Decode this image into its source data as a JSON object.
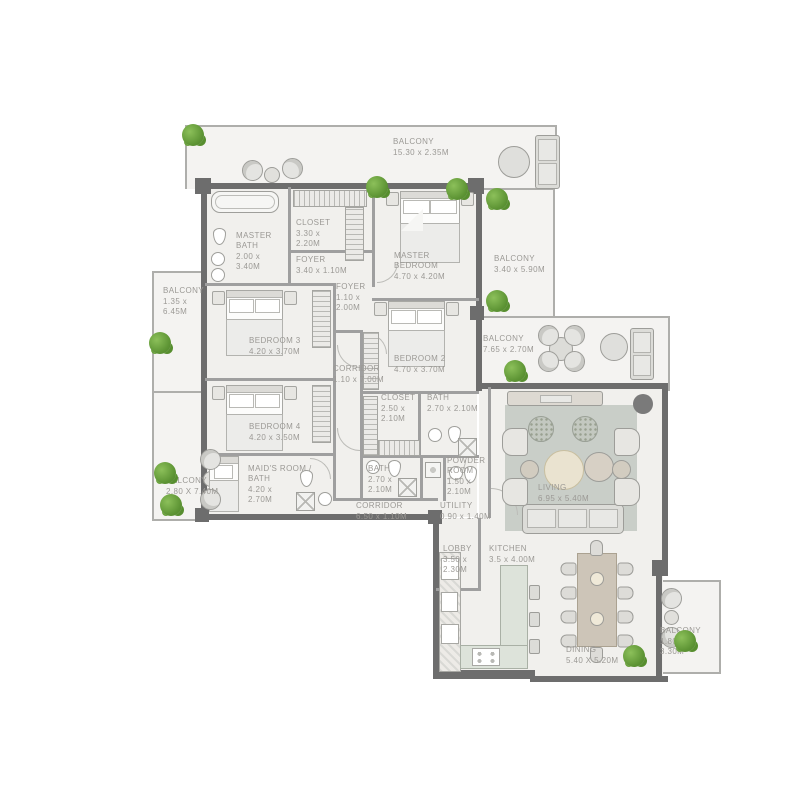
{
  "plan_title": "apartment-floor-plan",
  "rooms": [
    {
      "name": "BALCONY",
      "dims": "15.30 x 2.35M"
    },
    {
      "name": "MASTER BATH",
      "dims": "2.00 x 3.40M"
    },
    {
      "name": "CLOSET",
      "dims": "3.30 x 2.20M"
    },
    {
      "name": "FOYER",
      "dims": "3.40 x 1.10M"
    },
    {
      "name": "MASTER BEDROOM",
      "dims": "4.70 x 4.20M"
    },
    {
      "name": "BALCONY",
      "dims": "3.40 x 5.90M"
    },
    {
      "name": "BALCONY",
      "dims": "1.35 x 6.45M"
    },
    {
      "name": "FOYER",
      "dims": "1.10 x 2.00M"
    },
    {
      "name": "BEDROOM 3",
      "dims": "4.20 x 3.70M"
    },
    {
      "name": "BEDROOM 2",
      "dims": "4.70 x 3.70M"
    },
    {
      "name": "CORRIDOR",
      "dims": "1.10 x 7.00M"
    },
    {
      "name": "BALCONY",
      "dims": "7.65 x 2.70M"
    },
    {
      "name": "BEDROOM 4",
      "dims": "4.20 x 3.50M"
    },
    {
      "name": "CLOSET",
      "dims": "2.50 x 2.10M"
    },
    {
      "name": "BATH",
      "dims": "2.70 x 2.10M"
    },
    {
      "name": "MAID'S ROOM / BATH",
      "dims": "4.20 x 2.70M"
    },
    {
      "name": "BATH",
      "dims": "2.70 x 2.10M"
    },
    {
      "name": "BALCONY",
      "dims": "2.80 X 7.40M"
    },
    {
      "name": "POWDER ROOM",
      "dims": "1.50 x 2.10M"
    },
    {
      "name": "CORRIDOR",
      "dims": "6.50 x 1.10M"
    },
    {
      "name": "UTILITY",
      "dims": "0.90 x 1.40M"
    },
    {
      "name": "LIVING",
      "dims": "6.95 x 5.40M"
    },
    {
      "name": "LOBBY",
      "dims": "3.50 x 2.30M"
    },
    {
      "name": "KITCHEN",
      "dims": "3.5 x 4.00M"
    },
    {
      "name": "DINING",
      "dims": "5.40 X 5.20M"
    },
    {
      "name": "BALCONY",
      "dims": "1.80 x 3.30M"
    }
  ],
  "colors": {
    "wall": "#6d6d6d",
    "partition": "#9f9f9f",
    "unit_floor": "#f1f0ed",
    "balcony_floor": "#f4f3f1",
    "label_text": "#9b9995",
    "plant_green": "#5d9434",
    "rug": "#c9cec8"
  }
}
